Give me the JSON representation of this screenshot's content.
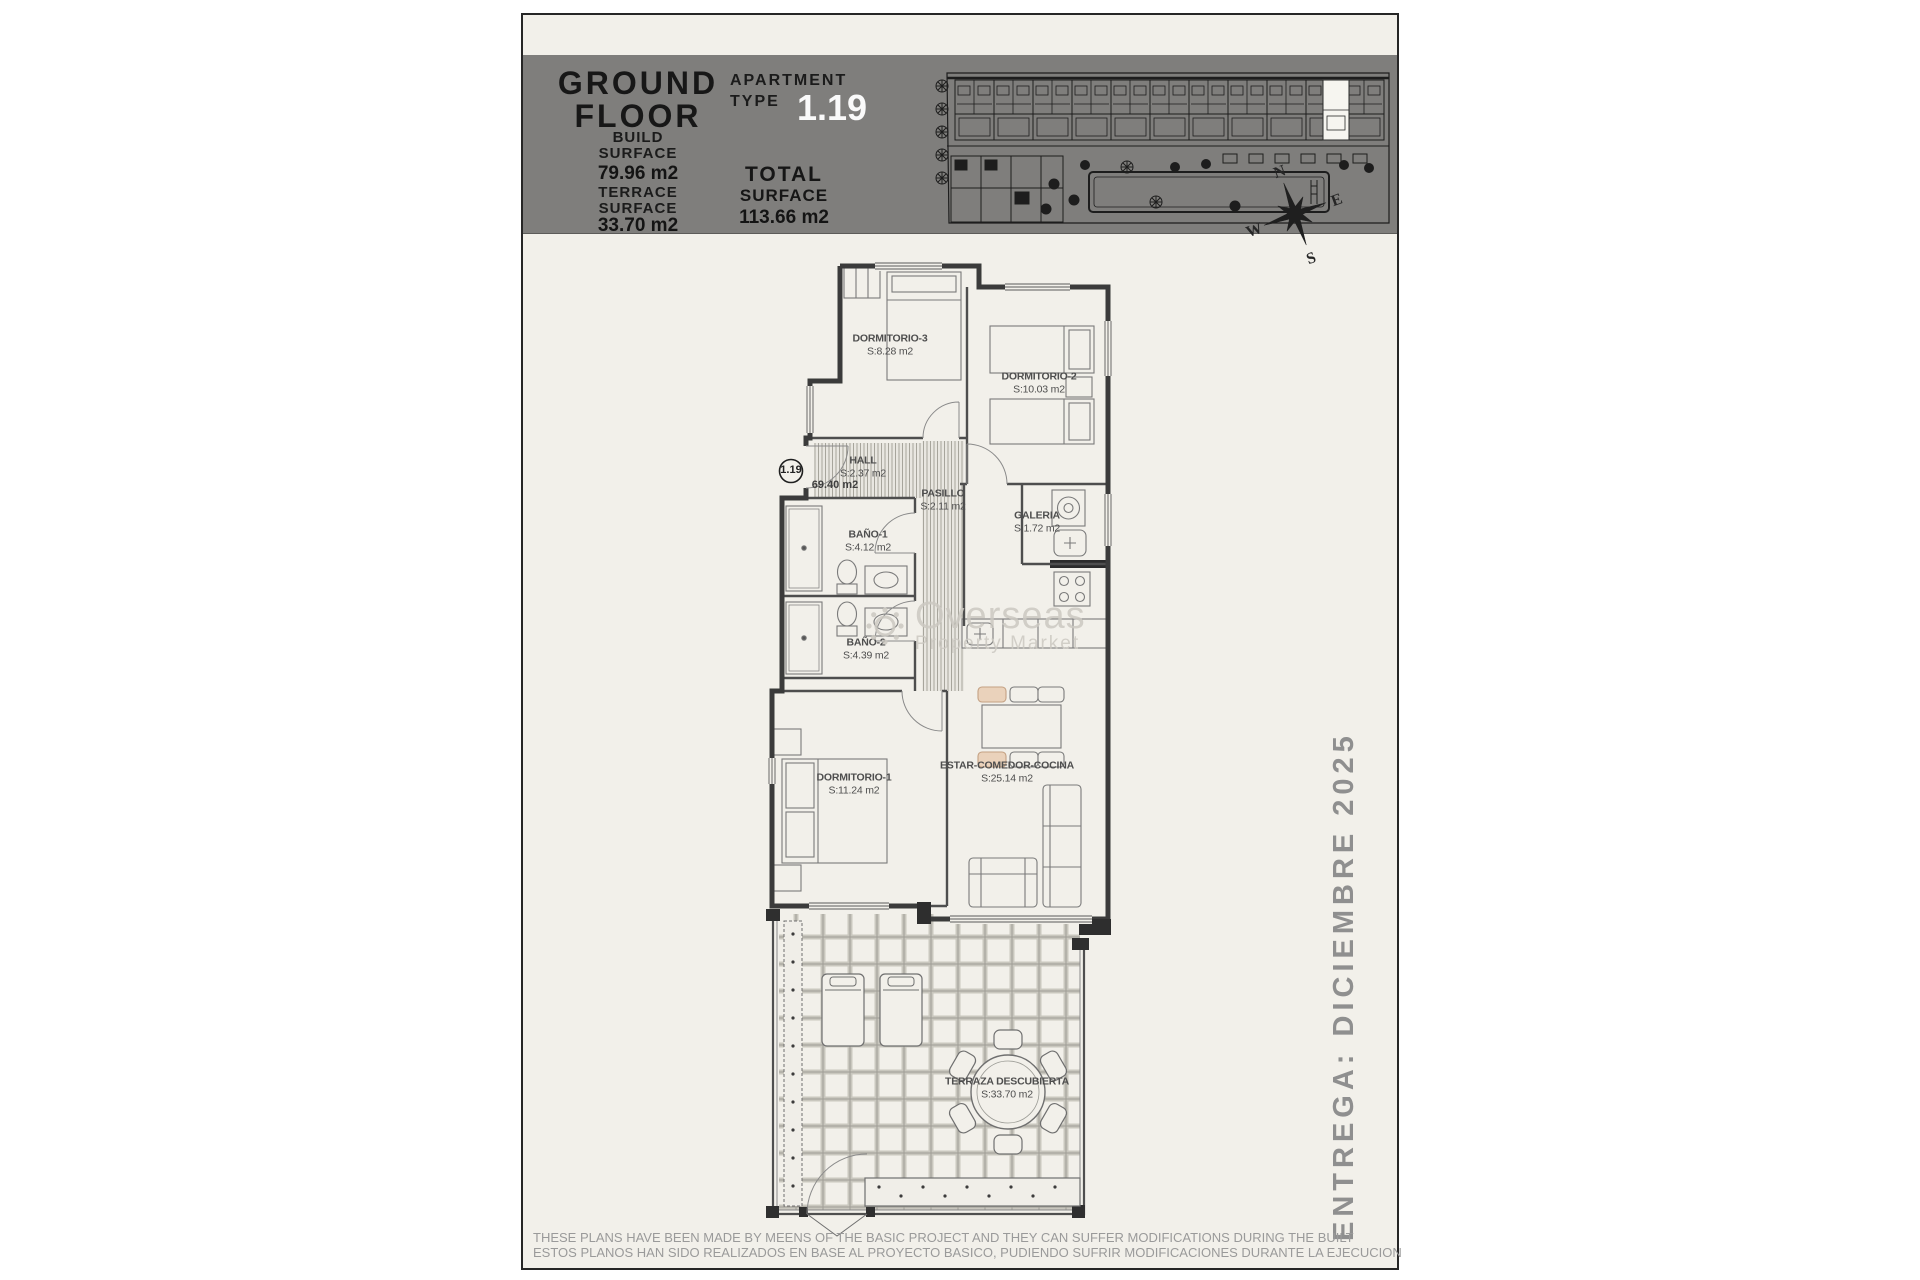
{
  "colors": {
    "band_gray": "#7f7e7c",
    "paper": "#f2f0ea",
    "apartment_number_white": "#fafafa",
    "chair_tan": "#ead2bb",
    "wall_dark": "#3b3b3b"
  },
  "header": {
    "title_line1": "GROUND",
    "title_line2": "FLOOR",
    "build_label": [
      "BUILD",
      "SURFACE"
    ],
    "build_value": "79.96 m2",
    "terrace_label": [
      "TERRACE",
      "SURFACE"
    ],
    "terrace_value": "33.70 m2",
    "apartment_label": [
      "APARTMENT",
      "TYPE"
    ],
    "apartment_number": "1.19",
    "total_label": [
      "TOTAL",
      "SURFACE"
    ],
    "total_value": "113.66 m2"
  },
  "compass": {
    "n": "N",
    "e": "E",
    "s": "S",
    "w": "W"
  },
  "unit_marker": {
    "number": "1.19",
    "plot_area": "69.40 m2"
  },
  "rooms": [
    {
      "name": "DORMITORIO-3",
      "area": "S:8.28 m2"
    },
    {
      "name": "DORMITORIO-2",
      "area": "S:10.03 m2"
    },
    {
      "name": "HALL",
      "area": "S:2.37 m2"
    },
    {
      "name": "PASILLO",
      "area": "S:2.11 m2"
    },
    {
      "name": "GALERIA",
      "area": "S:1.72 m2"
    },
    {
      "name": "BAÑO-1",
      "area": "S:4.12 m2"
    },
    {
      "name": "BAÑO-2",
      "area": "S:4.39 m2"
    },
    {
      "name": "DORMITORIO-1",
      "area": "S:11.24 m2"
    },
    {
      "name": "ESTAR-COMEDOR-COCINA",
      "area": "S:25.14 m2"
    },
    {
      "name": "TERRAZA DESCUBIERTA",
      "area": "S:33.70 m2"
    }
  ],
  "watermark": {
    "word1": "Overseas",
    "word2": "Property Market"
  },
  "delivery_note": "ENTREGA: DICIEMBRE 2025",
  "disclaimer": {
    "line_en": "THESE PLANS HAVE BEEN MADE BY MEENS OF THE BASIC PROJECT AND THEY CAN SUFFER MODIFICATIONS DURING THE BUILT",
    "line_es": "ESTOS PLANOS HAN SIDO REALIZADOS EN BASE AL PROYECTO BASICO, PUDIENDO SUFRIR MODIFICACIONES DURANTE LA EJECUCION"
  }
}
